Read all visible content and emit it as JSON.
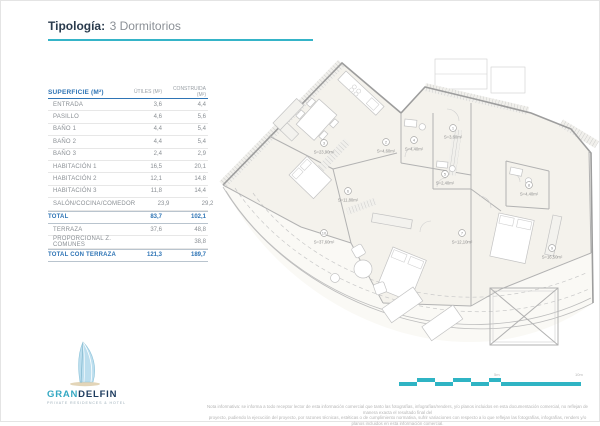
{
  "title": {
    "label": "Tipología:",
    "value": "3 Dormitorios"
  },
  "colors": {
    "accent_teal": "#35b4c8",
    "table_blue": "#2e74b5",
    "brand_navy": "#1c3b5e",
    "brand_teal": "#35a9c3"
  },
  "table": {
    "headers": {
      "col1": "SUPERFICIE (M²)",
      "col2": "ÚTILES (M²)",
      "col3": "CONSTRUIDA (M²)"
    },
    "rows": [
      {
        "label": "ENTRADA",
        "utiles": "3,6",
        "construida": "4,4"
      },
      {
        "label": "PASILLO",
        "utiles": "4,6",
        "construida": "5,6"
      },
      {
        "label": "BAÑO 1",
        "utiles": "4,4",
        "construida": "5,4"
      },
      {
        "label": "BAÑO 2",
        "utiles": "4,4",
        "construida": "5,4"
      },
      {
        "label": "BAÑO 3",
        "utiles": "2,4",
        "construida": "2,9"
      },
      {
        "label": "HABITACIÓN 1",
        "utiles": "16,5",
        "construida": "20,1"
      },
      {
        "label": "HABITACIÓN 2",
        "utiles": "12,1",
        "construida": "14,8"
      },
      {
        "label": "HABITACIÓN 3",
        "utiles": "11,8",
        "construida": "14,4"
      },
      {
        "label": "SALÓN/COCINA/COMEDOR",
        "utiles": "23,9",
        "construida": "29,2"
      }
    ],
    "total": {
      "label": "TOTAL",
      "utiles": "83,7",
      "construida": "102,1"
    },
    "extra_rows": [
      {
        "label": "TERRAZA",
        "utiles": "37,6",
        "construida": "48,8"
      },
      {
        "label": "PROPORCIONAL Z. COMUNES",
        "utiles": "",
        "construida": "38,8"
      }
    ],
    "grand_total": {
      "label": "TOTAL CON TERRAZA",
      "utiles": "121,3",
      "construida": "189,7"
    }
  },
  "plan": {
    "labels": [
      {
        "room": "salon",
        "num": "3",
        "area": "S=23,90m²"
      },
      {
        "room": "pasillo",
        "num": "2",
        "area": "S=4,60m²"
      },
      {
        "room": "bano1",
        "num": "4",
        "area": "S=4,40m²"
      },
      {
        "room": "entrada",
        "num": "1",
        "area": "S=3,60m²"
      },
      {
        "room": "bano3",
        "num": "5",
        "area": "S=2,40m²"
      },
      {
        "room": "hab3",
        "num": "6",
        "area": "S=11,80m²"
      },
      {
        "room": "bano2",
        "num": "8",
        "area": "S=4,40m²"
      },
      {
        "room": "hab2",
        "num": "7",
        "area": "S=12,10m²"
      },
      {
        "room": "hab1",
        "num": "9",
        "area": "S=16,50m²"
      },
      {
        "room": "terraza",
        "num": "10",
        "area": "S=37,60m²"
      }
    ]
  },
  "scalebar": {
    "mid_label": "5m",
    "end_label": "10m"
  },
  "logo": {
    "gran": "GRAN",
    "delfin": "DELFIN",
    "tagline": "PRIVATE RESIDENCES & HOTEL"
  },
  "disclaimer": {
    "line1": "Nota informativa: se informa a todo receptor lector de esta información comercial que tanto las fotografías, infografías/renders, y/o planos incluidos en esta documentación comercial, no reflejan de manera exacta el resultado final del",
    "line2": "proyecto, pudiendo la ejecución del proyecto, por razones técnicas, estéticas o de cumplimiento normativa, sufrir variaciones con respecto a lo que reflejan las fotografías, infografías, renders y/o planos incluidos en esta información comercial."
  }
}
